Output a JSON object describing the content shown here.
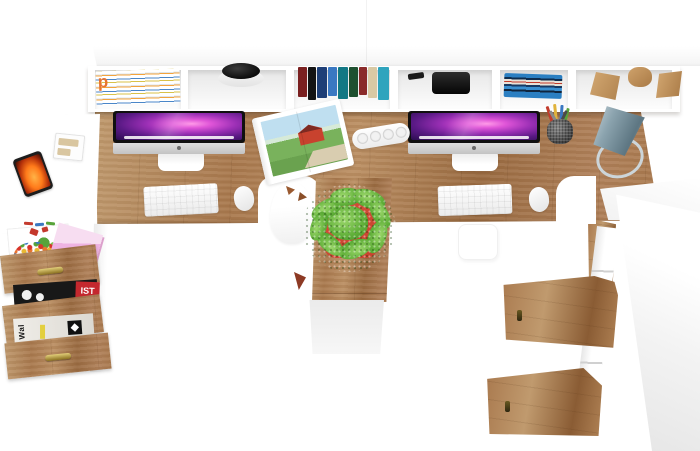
{
  "scene": {
    "type": "3d-furniture-render",
    "view": "top-down",
    "description": "Top view render of a two-person oak and white home-office workstation: wall hutch with open cubbies, double desk with two iMacs, keyboards and mice, left white return with open three-drawer pedestal, center oak column with potted plant, and tall white cabinet with two open oak doors on the right.",
    "background_color": "#ffffff"
  },
  "palette": {
    "wood-light": "#c09a6e",
    "wood-mid": "#a9794e",
    "wood-dark": "#8a5c34",
    "white": "#ffffff",
    "shelf-shadow": "#e7e7e7",
    "screen-magenta": "#e055d8",
    "screen-deep": "#2a0d4e",
    "lamp-gray": "#8ba3ae",
    "lamp-gray-dark": "#5d7682",
    "plant-green": "#5fae38",
    "plant-green-light": "#9ad66a",
    "pot-red": "#c8422e",
    "sticky-pink": "#eeb3e2"
  },
  "text": {
    "magazine_spine_letter": "p",
    "black_magazine_label": "IST",
    "newspaper_masthead": "Wal"
  },
  "furniture": {
    "hutch": {
      "label": "wall hutch with open cubbies",
      "cubby_contents": [
        "stack of magazines",
        "black bowl",
        "row of colored books",
        "black speaker",
        "stack of blue books",
        "wooden blocks"
      ]
    },
    "desk": {
      "label": "double workstation desk with oak top",
      "monitors": 2
    },
    "left_return": {
      "label": "white side return desk",
      "items": [
        "smartphone",
        "small desk organizer"
      ]
    },
    "drawer_unit": {
      "label": "three-drawer pedestal with open drawers",
      "drawer_contents": [
        "sticky notes, candies, green toy, pencils",
        "black magazines",
        "folded newspaper"
      ]
    },
    "center_pedestal": {
      "label": "oak support column with potted plant"
    },
    "right_cabinet": {
      "label": "tall white cabinet with two open oak doors"
    },
    "desk_items": [
      "iMac monitor x2",
      "wireless keyboard x2",
      "wireless mouse x2",
      "open magazine with red barn photo",
      "power strip",
      "pencil cup",
      "cone desk lamp",
      "white shell chair"
    ]
  }
}
